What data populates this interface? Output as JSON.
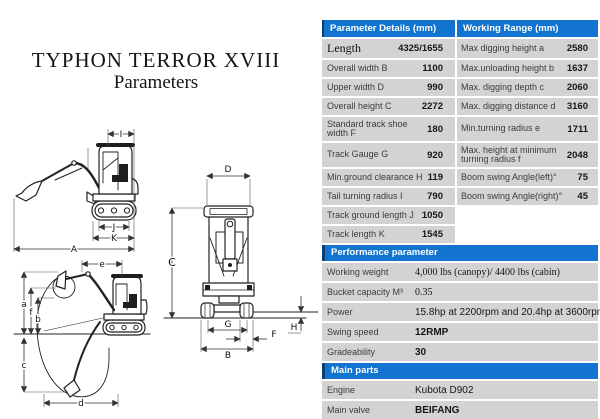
{
  "title": {
    "line1": "TYPHON TERROR XVIII",
    "line2": "Parameters"
  },
  "colors": {
    "header_blue": "#1274cf",
    "header_dark_edge": "#0a3f74",
    "row_gray": "#d3d3d3"
  },
  "dimensions_table": {
    "left_header": "Parameter Details (mm)",
    "right_header": "Working Range (mm)",
    "left_rows": [
      {
        "label": "Length",
        "value": "4325/1655"
      },
      {
        "label": "Overall width B",
        "value": "1100"
      },
      {
        "label": "Upper width D",
        "value": "990"
      },
      {
        "label": "Overall height C",
        "value": "2272"
      },
      {
        "label": "Standard track shoe width F",
        "value": "180"
      },
      {
        "label": "Track Gauge G",
        "value": "920"
      },
      {
        "label": "Min.ground clearance H",
        "value": "119"
      },
      {
        "label": "Tail turning radius I",
        "value": "790"
      },
      {
        "label": "Track ground length J",
        "value": "1050"
      },
      {
        "label": "Track length K",
        "value": "1545"
      }
    ],
    "right_rows": [
      {
        "label": "Max digging height a",
        "value": "2580"
      },
      {
        "label": "Max.unloading height b",
        "value": "1637"
      },
      {
        "label": "Max. digging depth c",
        "value": "2060"
      },
      {
        "label": "Max. digging distance d",
        "value": "3160"
      },
      {
        "label": "Min.turning radius e",
        "value": "1711"
      },
      {
        "label": "Max. height at minimum turning radius f",
        "value": "2048"
      },
      {
        "label": "Boom swing Angle(left)°",
        "value": "75"
      },
      {
        "label": "Boom swing Angle(right)°",
        "value": "45"
      }
    ]
  },
  "performance": {
    "header": "Performance parameter",
    "rows": [
      {
        "label": "Working weight",
        "value": "4,000 lbs (canopy)/ 4400 lbs (cabin)"
      },
      {
        "label": "Bucket capacity M³",
        "value": "0.35"
      },
      {
        "label": "Power",
        "value": "15.8hp at 2200rpm and 20.4hp at 3600rpm"
      },
      {
        "label": "Swing speed",
        "value": "12RMP"
      },
      {
        "label": "Gradeability",
        "value": "30"
      }
    ]
  },
  "main_parts": {
    "header": "Main parts",
    "rows": [
      {
        "label": "Engine",
        "value": "Kubota D902"
      },
      {
        "label": "Main valve",
        "value": "BEIFANG"
      }
    ]
  },
  "diagram": {
    "labels": {
      "A": "A",
      "I": "I",
      "J": "J",
      "K": "K",
      "B": "B",
      "C": "C",
      "D": "D",
      "G": "G",
      "F": "F",
      "H": "H",
      "a": "a",
      "b": "b",
      "c": "c",
      "d": "d",
      "e": "e",
      "f": "f"
    }
  }
}
